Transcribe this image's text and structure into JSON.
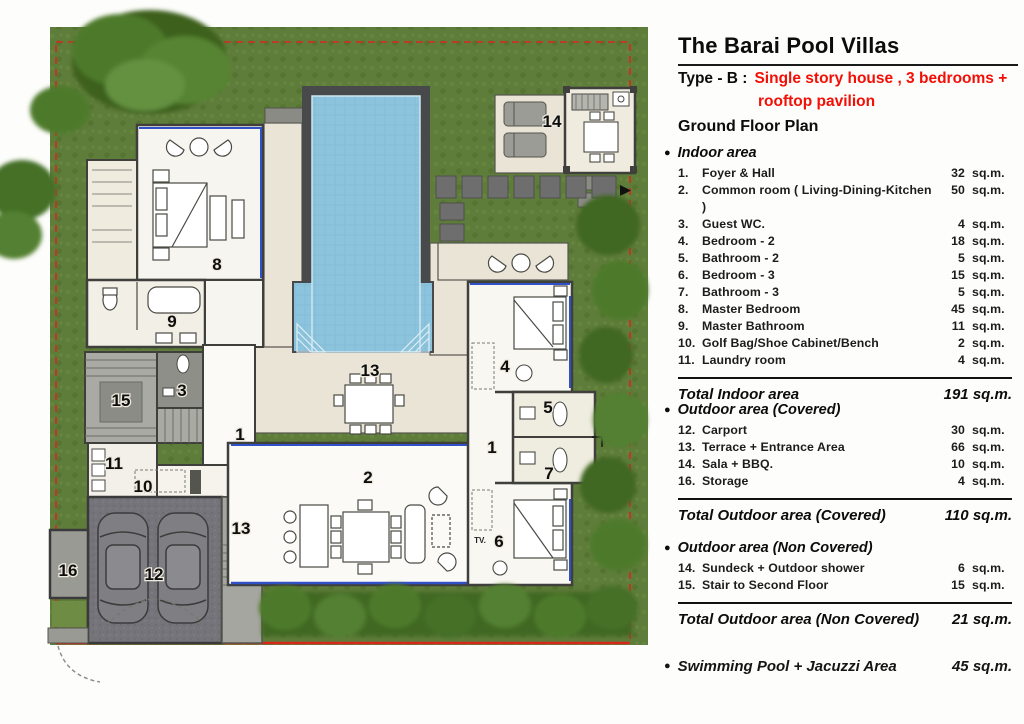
{
  "icons": {
    "bullet": "●"
  },
  "panel": {
    "title": "The Barai Pool Villas",
    "type_prefix": "Type - B :",
    "type_line1": "Single story house , 3 bedrooms +",
    "type_line2": "rooftop  pavilion",
    "plan_name": "Ground Floor Plan",
    "indoor": {
      "heading": "Indoor area",
      "items": [
        {
          "num": "1.",
          "label": "Foyer & Hall",
          "value": "32",
          "unit": "sq.m."
        },
        {
          "num": "2.",
          "label": "Common room ( Living-Dining-Kitchen )",
          "value": "50",
          "unit": "sq.m."
        },
        {
          "num": "3.",
          "label": "Guest WC.",
          "value": "4",
          "unit": "sq.m."
        },
        {
          "num": "4.",
          "label": "Bedroom - 2",
          "value": "18",
          "unit": "sq.m."
        },
        {
          "num": "5.",
          "label": "Bathroom - 2",
          "value": "5",
          "unit": "sq.m."
        },
        {
          "num": "6.",
          "label": "Bedroom - 3",
          "value": "15",
          "unit": "sq.m."
        },
        {
          "num": "7.",
          "label": "Bathroom - 3",
          "value": "5",
          "unit": "sq.m."
        },
        {
          "num": "8.",
          "label": "Master Bedroom",
          "value": "45",
          "unit": "sq.m."
        },
        {
          "num": "9.",
          "label": "Master Bathroom",
          "value": "11",
          "unit": "sq.m."
        },
        {
          "num": "10.",
          "label": "Golf Bag/Shoe Cabinet/Bench",
          "value": "2",
          "unit": "sq.m."
        },
        {
          "num": "11.",
          "label": "Laundry room",
          "value": "4",
          "unit": "sq.m."
        }
      ],
      "total_label": "Total Indoor area",
      "total_value": "191 sq.m."
    },
    "outdoor_covered": {
      "heading": "Outdoor area (Covered)",
      "items": [
        {
          "num": "12.",
          "label": "Carport",
          "value": "30",
          "unit": "sq.m."
        },
        {
          "num": "13.",
          "label": "Terrace + Entrance Area",
          "value": "66",
          "unit": "sq.m."
        },
        {
          "num": "14.",
          "label": "Sala + BBQ.",
          "value": "10",
          "unit": "sq.m."
        },
        {
          "num": "16.",
          "label": "Storage",
          "value": "4",
          "unit": "sq.m."
        }
      ],
      "total_label": "Total Outdoor area (Covered)",
      "total_value": "110 sq.m."
    },
    "outdoor_noncovered": {
      "heading": "Outdoor area (Non Covered)",
      "items": [
        {
          "num": "14.",
          "label": "Sundeck + Outdoor shower",
          "value": "6",
          "unit": "sq.m."
        },
        {
          "num": "15.",
          "label": "Stair to Second Floor",
          "value": "15",
          "unit": "sq.m."
        }
      ],
      "total_label": "Total Outdoor area (Non Covered)",
      "total_value": "21 sq.m."
    },
    "pool_total": {
      "label": "Swimming Pool + Jacuzzi Area",
      "value": "45 sq.m."
    }
  },
  "plan": {
    "labels": [
      {
        "text": "8"
      },
      {
        "text": "9"
      },
      {
        "text": "15"
      },
      {
        "text": "3"
      },
      {
        "text": "1"
      },
      {
        "text": "11"
      },
      {
        "text": "10"
      },
      {
        "text": "16"
      },
      {
        "text": "12"
      },
      {
        "text": "13"
      },
      {
        "text": "13"
      },
      {
        "text": "2"
      },
      {
        "text": "1"
      },
      {
        "text": "4"
      },
      {
        "text": "5"
      },
      {
        "text": "7"
      },
      {
        "text": "6"
      },
      {
        "text": "14"
      },
      {
        "text": "TV."
      }
    ]
  }
}
